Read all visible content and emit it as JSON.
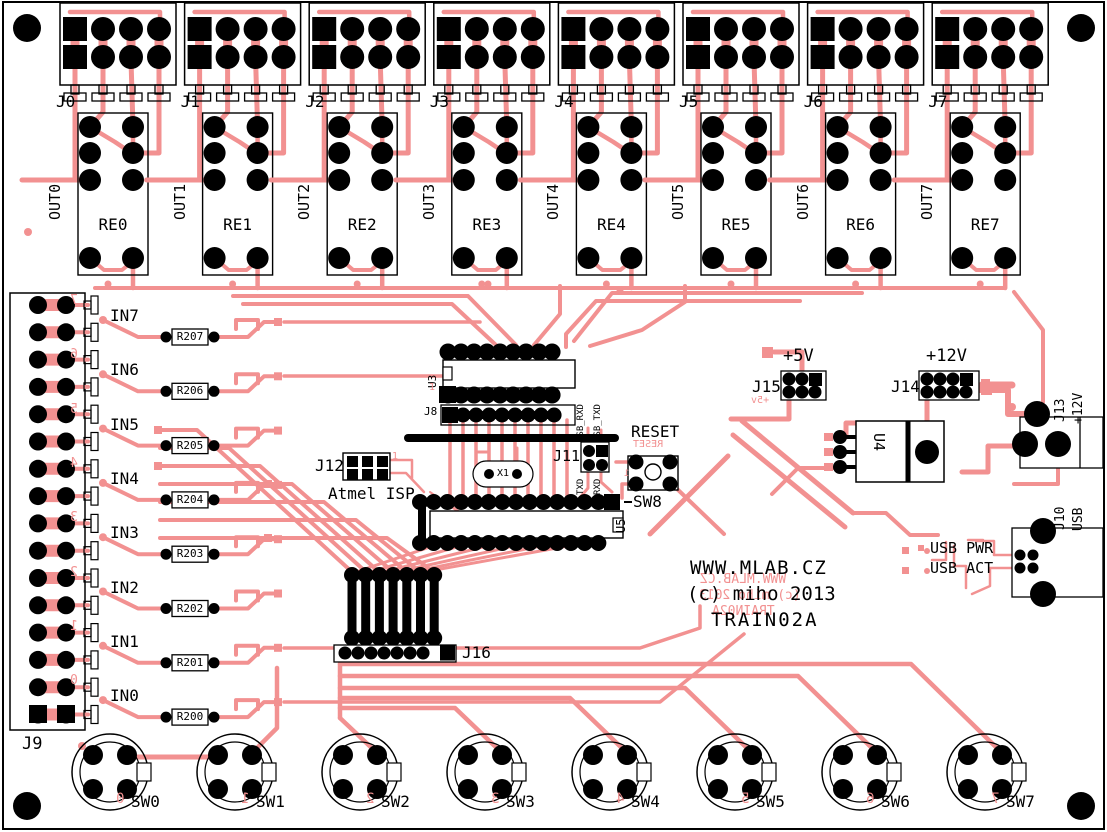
{
  "board": {
    "copper_color": "#f29191",
    "silk_color": "#000000",
    "title_url": "WWW.MLAB.CZ",
    "title_copyright": "(c) miho 2013",
    "title_name": "TRAIN02A"
  },
  "output_channels": [
    {
      "connector": "J0",
      "out": "OUT0",
      "relay": "RE0"
    },
    {
      "connector": "J1",
      "out": "OUT1",
      "relay": "RE1"
    },
    {
      "connector": "J2",
      "out": "OUT2",
      "relay": "RE2"
    },
    {
      "connector": "J3",
      "out": "OUT3",
      "relay": "RE3"
    },
    {
      "connector": "J4",
      "out": "OUT4",
      "relay": "RE4"
    },
    {
      "connector": "J5",
      "out": "OUT5",
      "relay": "RE5"
    },
    {
      "connector": "J6",
      "out": "OUT6",
      "relay": "RE6"
    },
    {
      "connector": "J7",
      "out": "OUT7",
      "relay": "RE7"
    }
  ],
  "inputs": [
    {
      "label": "IN7",
      "resistor": "R207",
      "digit": "7"
    },
    {
      "label": "IN6",
      "resistor": "R206",
      "digit": "6"
    },
    {
      "label": "IN5",
      "resistor": "R205",
      "digit": "5"
    },
    {
      "label": "IN4",
      "resistor": "R204",
      "digit": "4"
    },
    {
      "label": "IN3",
      "resistor": "R203",
      "digit": "3"
    },
    {
      "label": "IN2",
      "resistor": "R202",
      "digit": "2"
    },
    {
      "label": "IN1",
      "resistor": "R201",
      "digit": "1"
    },
    {
      "label": "IN0",
      "resistor": "R200",
      "digit": "0"
    }
  ],
  "left": {
    "connector_label": "J9"
  },
  "switches": [
    {
      "label": "SW0",
      "digit": "0"
    },
    {
      "label": "SW1",
      "digit": "1"
    },
    {
      "label": "SW2",
      "digit": "2"
    },
    {
      "label": "SW3",
      "digit": "3"
    },
    {
      "label": "SW4",
      "digit": "4"
    },
    {
      "label": "SW5",
      "digit": "5"
    },
    {
      "label": "SW6",
      "digit": "6"
    },
    {
      "label": "SW7",
      "digit": "7"
    }
  ],
  "center": {
    "u3": "U3",
    "j8": "J8",
    "u3_pin1": "1",
    "j11": "J11",
    "usb_rxd": "USB_RXD",
    "usb_txd": "USB_TXD",
    "txd": "TXD",
    "rxd": "RXD",
    "x1": "X1",
    "j12": "J12",
    "j12_pin1": "1",
    "atmel_isp": "Atmel ISP",
    "reset": "RESET",
    "reset_mirror": "RESET",
    "sw8": "SW8",
    "sw8_pin1": "1",
    "u5": "U5",
    "j16": "J16"
  },
  "power": {
    "plus5v": "+5V",
    "j15": "J15",
    "plus5v_mirror": "+5v",
    "plus12v": "+12V",
    "j14": "J14",
    "u4": "U4",
    "j13": "J13",
    "j13_voltage": "+12V",
    "j10": "J10",
    "j10_type": "USB",
    "usb_pwr": "USB PWR",
    "usb_act": "USB ACT"
  }
}
